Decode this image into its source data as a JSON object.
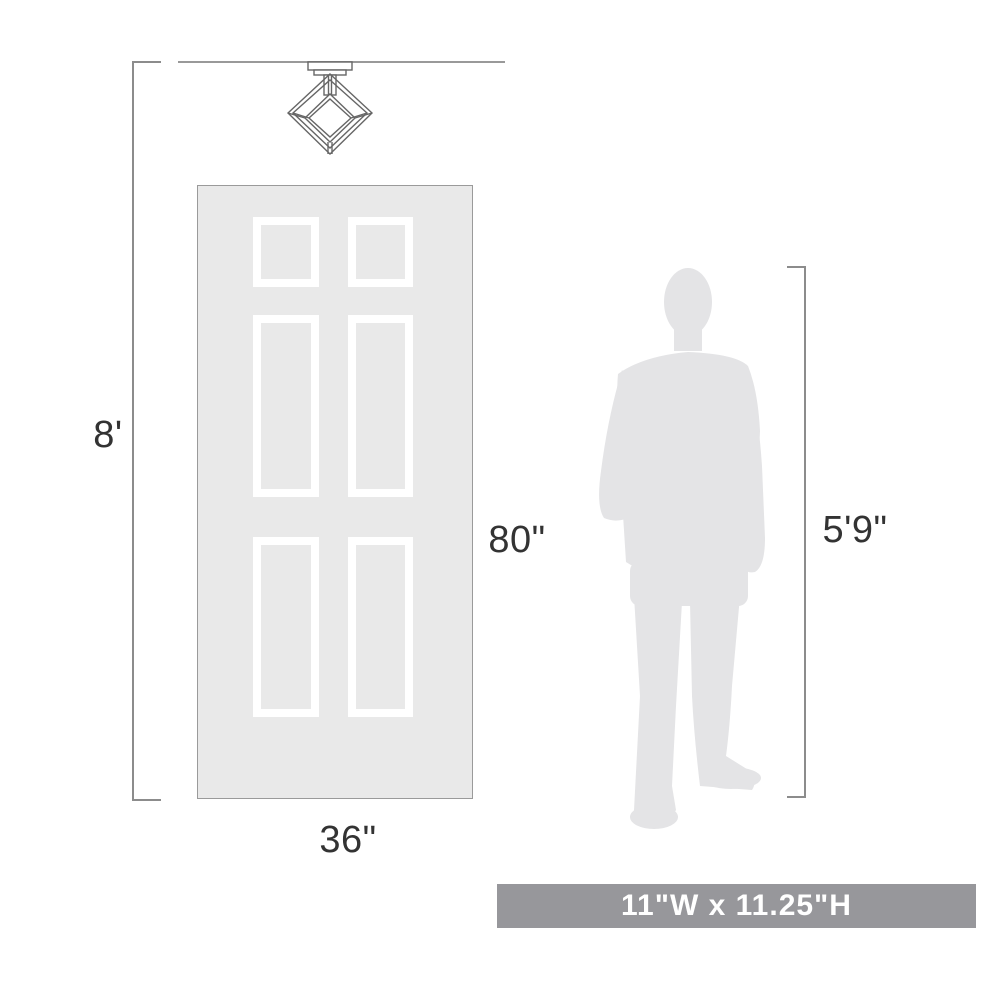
{
  "diagram": {
    "title": "product-scale-dimension-diagram",
    "labels": {
      "ceiling_height": "8'",
      "door_height": "80\"",
      "door_width": "36\"",
      "person_height": "5'9\""
    },
    "banner": {
      "text": "11\"W x 11.25\"H"
    },
    "icons": {
      "fixture": "cube-cage-semi-flush-light-icon",
      "person": "standing-man-silhouette",
      "door": "six-panel-door-graphic"
    },
    "colors": {
      "banner_bg": "#97979b",
      "banner_text": "#ffffff",
      "door_fill": "#e9e9e9",
      "door_border": "#9a9a9a",
      "panel_border": "#ffffff",
      "silhouette_fill": "#e4e4e6",
      "dimension_line": "#8c8c8c",
      "ceiling_line": "#999999",
      "label_text": "#333333",
      "fixture_stroke": "#666666"
    }
  }
}
